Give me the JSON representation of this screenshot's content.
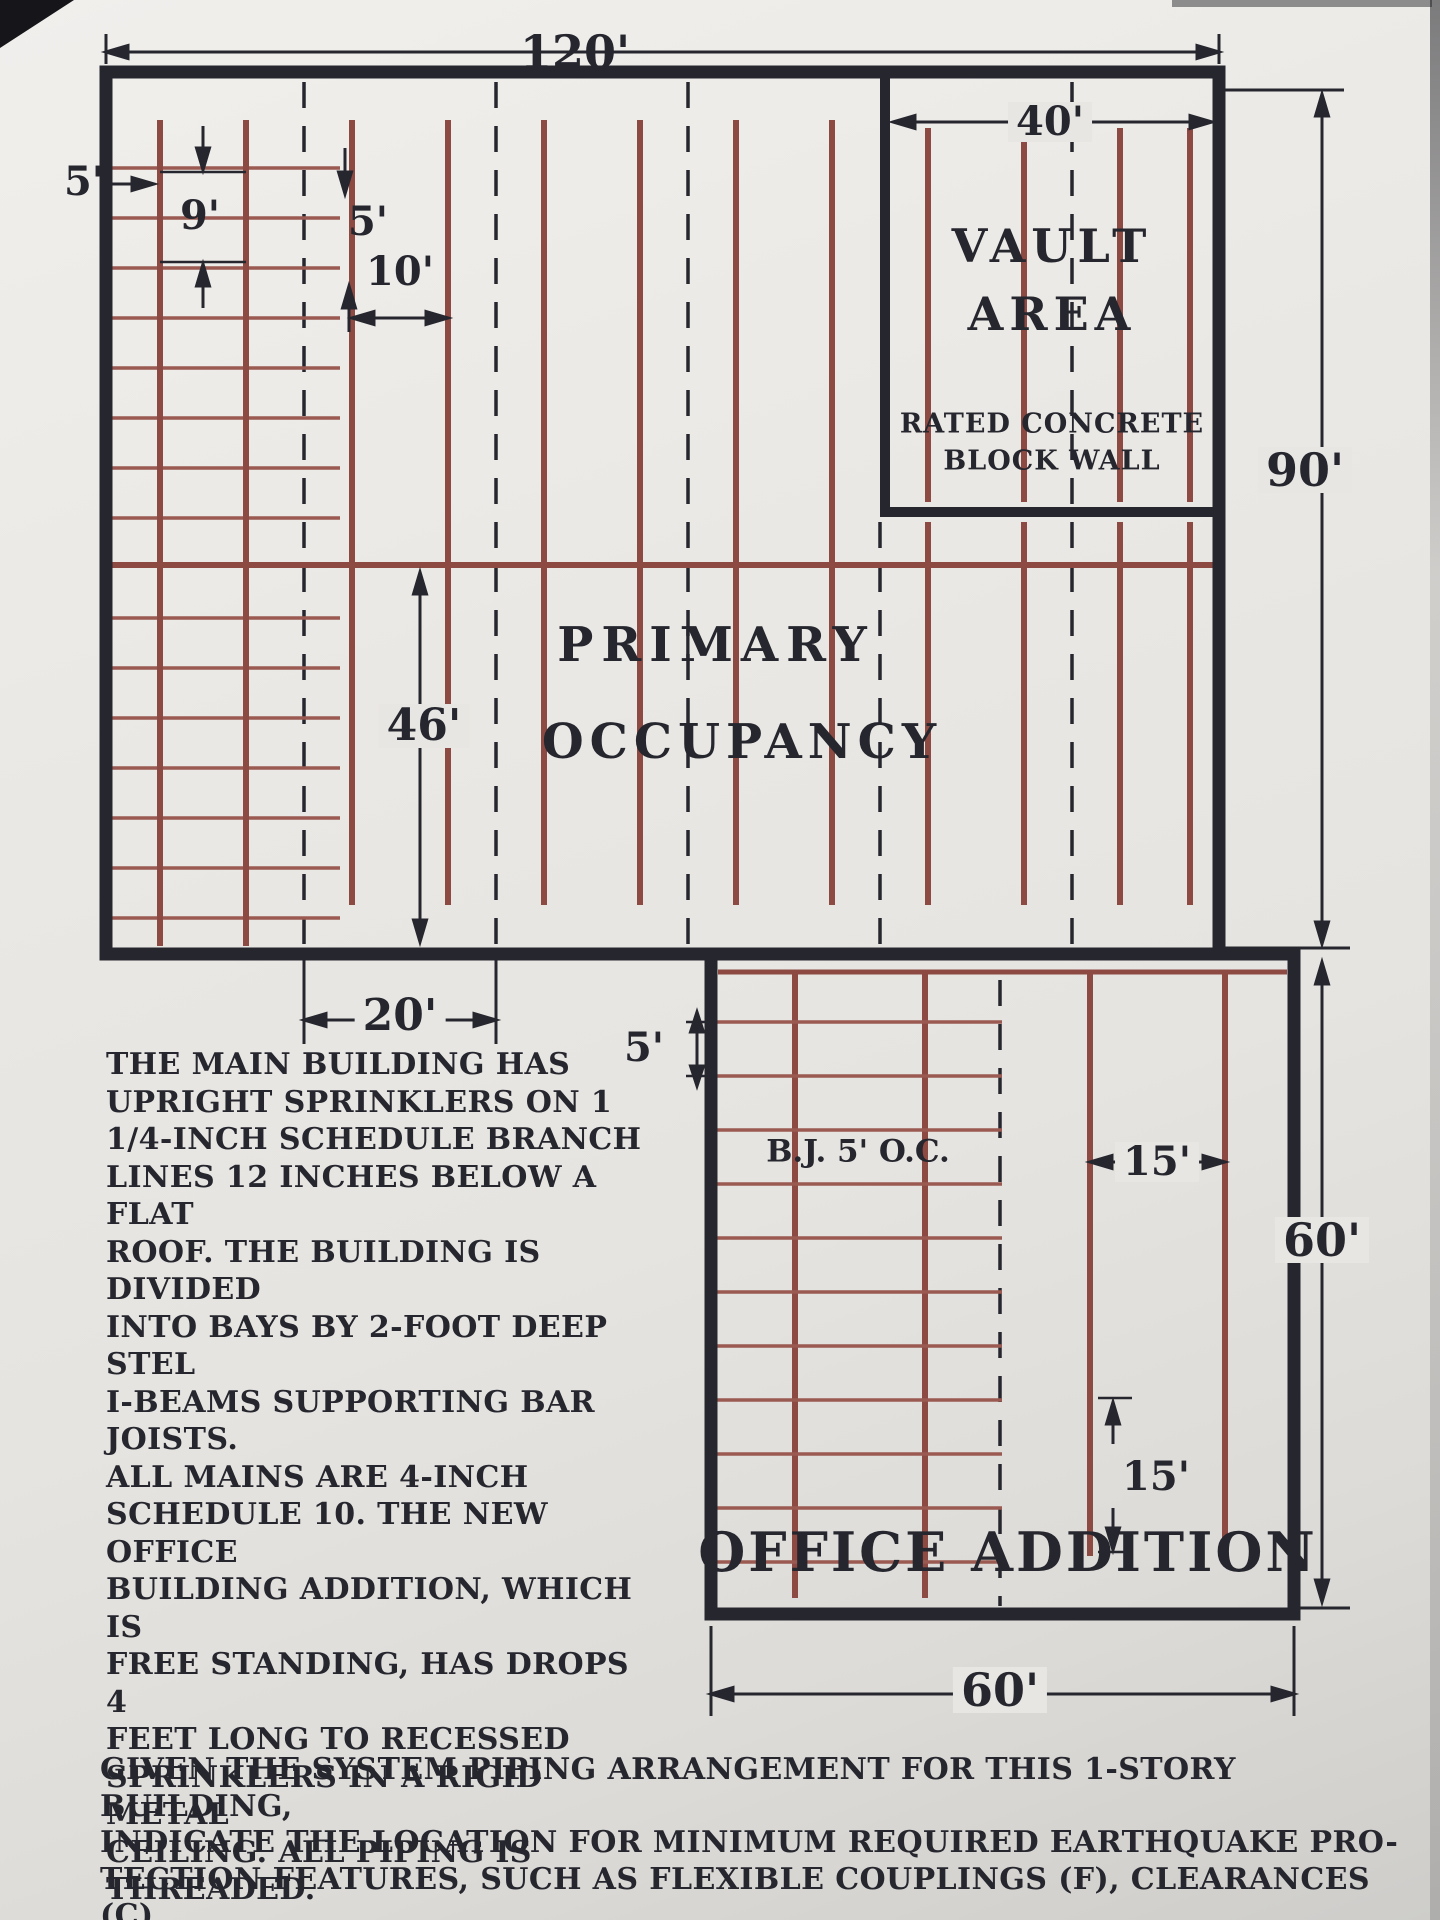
{
  "colors": {
    "paper": "#e8e6e2",
    "ink": "#26262f",
    "pipe": "#8d4a43"
  },
  "dimensions": {
    "building_width": "120'",
    "wall_to_first_line": "5'",
    "ladder_mains_gap": "9'",
    "line_to_bay_gap": "5'",
    "branch_spacing": "10'",
    "vault_width": "40'",
    "building_height": "90'",
    "main_drop": "46'",
    "corner_bay": "20'",
    "office_joist_gap": "5'",
    "office_branch_gap_h": "15'",
    "office_branch_gap_v": "15'",
    "office_height": "60'",
    "office_width": "60'"
  },
  "labels": {
    "vault_line1": "VAULT",
    "vault_line2": "AREA",
    "vault_wall_line1": "RATED CONCRETE",
    "vault_wall_line2": "BLOCK WALL",
    "primary_line1": "PRIMARY",
    "primary_line2": "OCCUPANCY",
    "office_title": "OFFICE ADDITION",
    "bar_joist_note": "B.J. 5' O.C."
  },
  "notes": {
    "system_description": "THE MAIN BUILDING HAS\nUPRIGHT SPRINKLERS ON 1\n1/4-INCH SCHEDULE BRANCH\nLINES 12 INCHES BELOW A FLAT\nROOF. THE BUILDING IS DIVIDED\nINTO BAYS BY 2-FOOT DEEP STEL\nI-BEAMS SUPPORTING BAR JOISTS.\nALL MAINS ARE 4-INCH\nSCHEDULE 10. THE NEW OFFICE\nBUILDING ADDITION, WHICH IS\nFREE STANDING, HAS DROPS 4\nFEET LONG TO RECESSED\nSPRINKLERS IN A RIGID METAL\nCEILING. ALL PIPING IS\nTHREADED.",
    "question": "GIVEN THE SYSTEM PIPING ARRANGEMENT FOR THIS 1-STORY BUILDING,\nINDICATE THE LOCATION FOR MINIMUM REQUIRED EARTHQUAKE PRO-\nTECTION FEATURES, SUCH AS FLEXIBLE COUPLINGS (F), CLEARANCES (C),\nSWAY BRACES (↔), SEISMIC SEPARATION ASSEMBLIES (>) AND\nRESTRAINS (γ)."
  }
}
